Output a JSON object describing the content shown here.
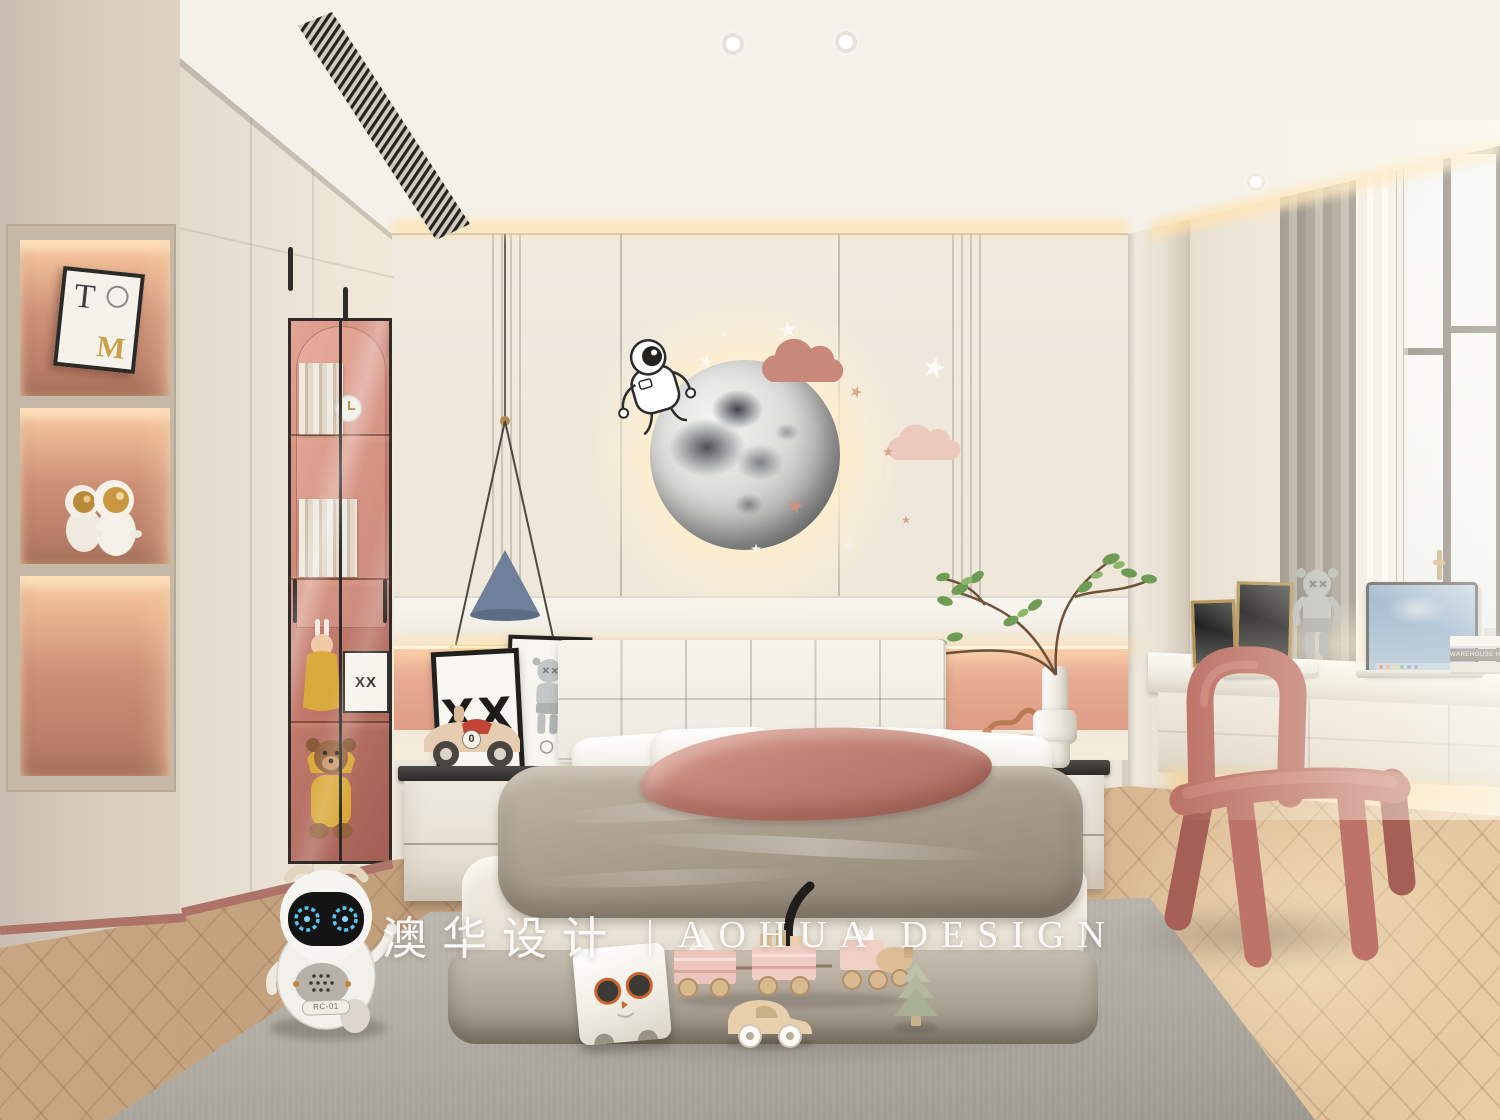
{
  "image": {
    "type": "interior-design-render",
    "room": "kids-bedroom",
    "style": "cream-pink space theme"
  },
  "watermark": {
    "cn": "澳华设计",
    "separator": "|",
    "en": "AOHUA DESIGN",
    "color": "#ffffff"
  },
  "texts": {
    "robot_badge": "RC-01",
    "poster_xx": "XX",
    "glass_card": "XX",
    "toy_car_number": "0",
    "book_spine": "WAREHOUSE HOME",
    "niche_art_t": "T",
    "niche_art_m": "M"
  },
  "palette": {
    "wall_cream": "#ece5da",
    "accent_pink_band": "#e8ab91",
    "niche_backlight": "#f0bd96",
    "glass_tint": "#c67a6b",
    "wood_floor": "#c9a783",
    "rug_gray": "#aca89f",
    "chair_rose": "#bd7368",
    "pendant_blue": "#6f809a",
    "duvet_taupe": "#a99d8e",
    "led_warm": "#ffdba6",
    "laptop_sky": "#6b92bc"
  },
  "objects": [
    "moon wall lamp",
    "astronaut wall decal",
    "pink cloud wall decor",
    "star wall decor",
    "tufted headboard bed",
    "pink throw blanket",
    "left nightstand with XX poster and toy race car",
    "right nightstand with vase branch plant",
    "backlit display niche with astronaut figurines",
    "pink glass-door wardrobe with teddy bear and clock",
    "cone pendant lamp",
    "floating desk",
    "laptop",
    "gold photo frames",
    "gray companion figure",
    "book stack",
    "window with city view",
    "sheer and gray curtains",
    "rose tube chair",
    "toy robot",
    "cat cube stool",
    "wooden toy train",
    "wooden toy car",
    "wooden toy tree",
    "herringbone wood floor",
    "gray rug"
  ]
}
